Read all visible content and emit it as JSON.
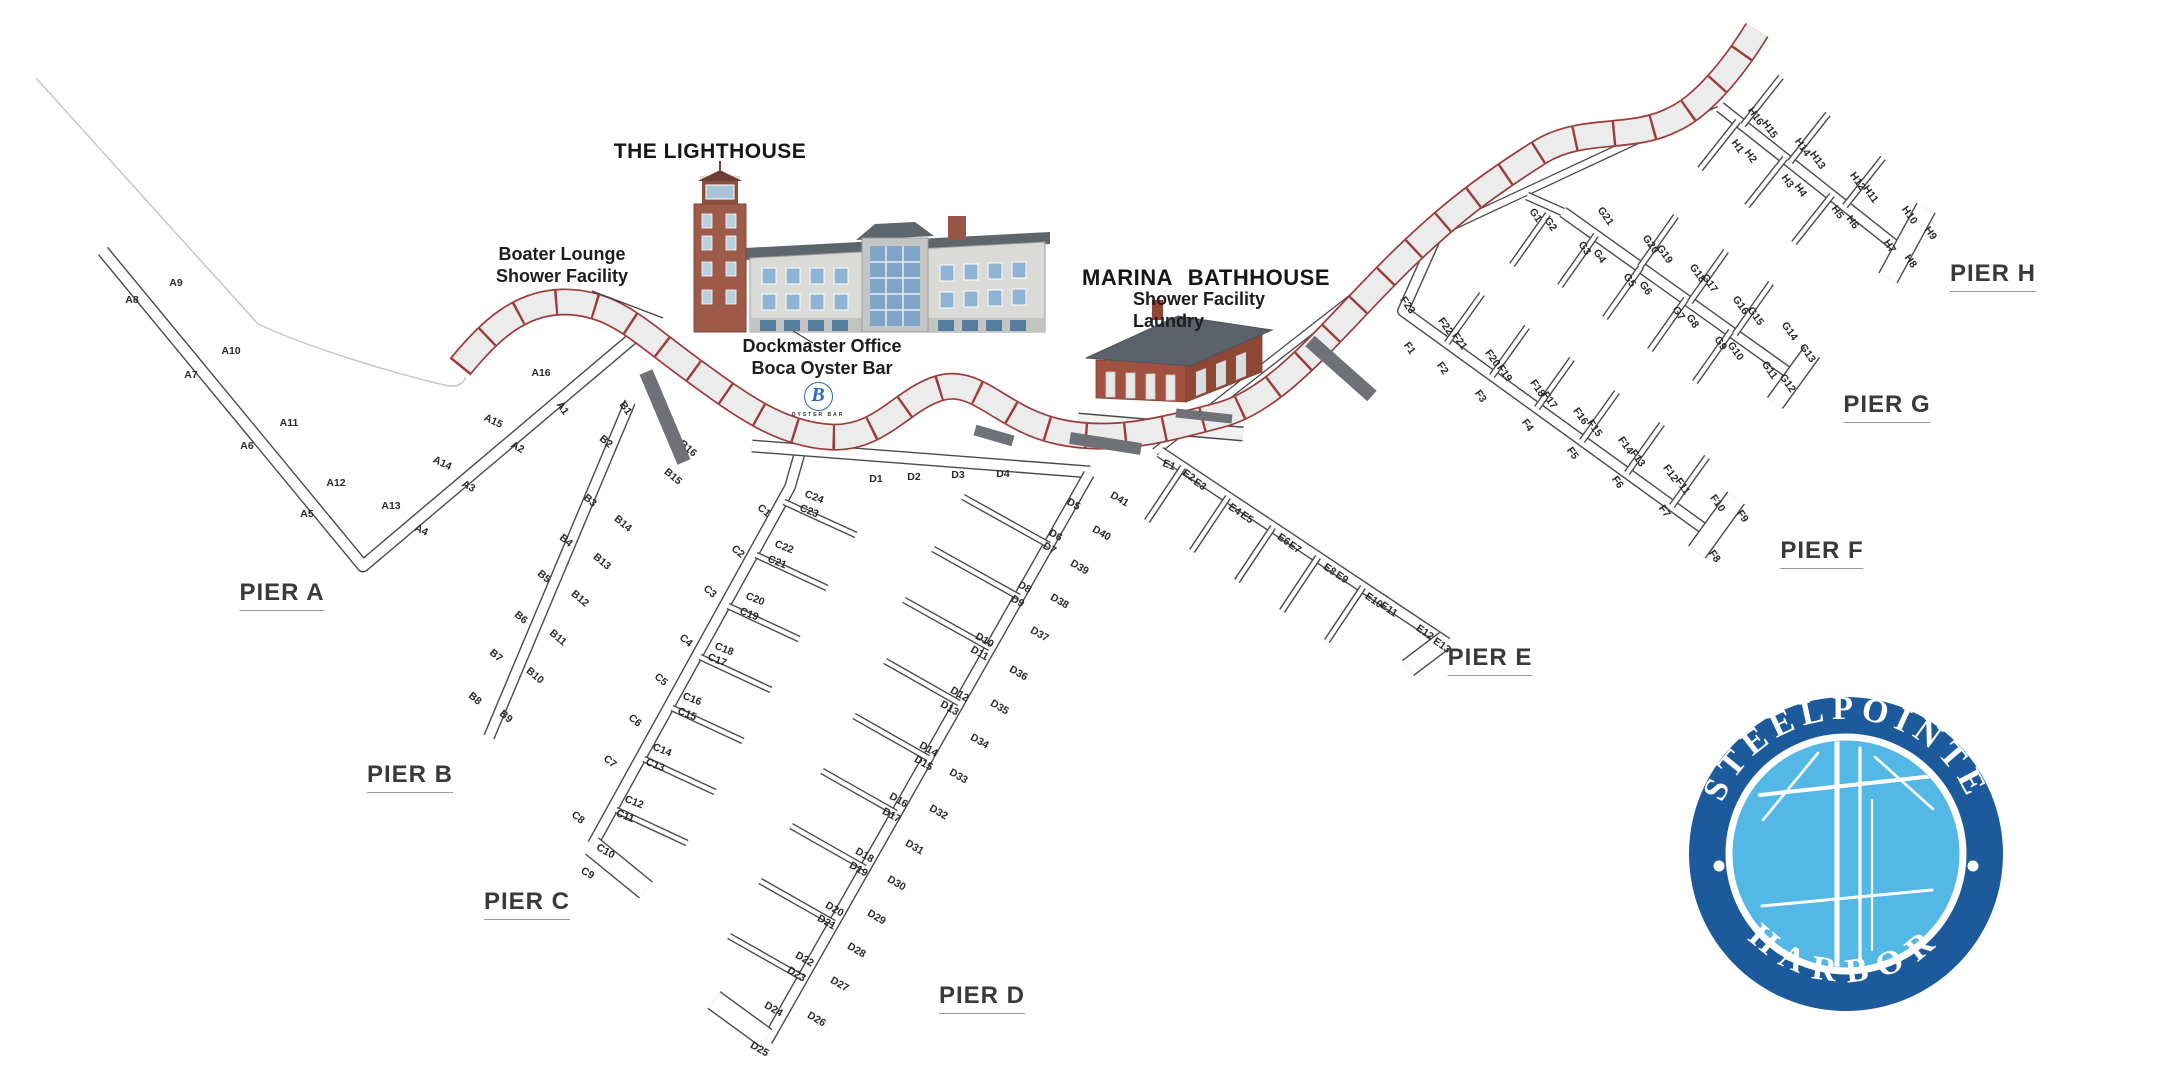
{
  "buildings": {
    "lighthouse": {
      "title": "THE LIGHTHOUSE",
      "callout_1": [
        "Boater Lounge",
        "Shower Facility"
      ],
      "callout_2": [
        "Dockmaster Office",
        "Boca Oyster Bar"
      ],
      "oyster_logo_letter": "B",
      "oyster_logo_caption": "OYSTER BAR"
    },
    "bathhouse": {
      "title": "MARINA  BATHHOUSE",
      "callout": [
        "Shower Facility",
        "Laundry"
      ]
    }
  },
  "piers": [
    {
      "id": "A",
      "label": "PIER A",
      "slips": [
        "A1",
        "A2",
        "A3",
        "A4",
        "A5",
        "A6",
        "A7",
        "A8",
        "A9",
        "A10",
        "A11",
        "A12",
        "A13",
        "A14",
        "A15",
        "A16"
      ]
    },
    {
      "id": "B",
      "label": "PIER B",
      "slips": [
        "B1",
        "B2",
        "B3",
        "B4",
        "B5",
        "B6",
        "B7",
        "B8",
        "B9",
        "B10",
        "B11",
        "B12",
        "B13",
        "B14",
        "B15",
        "B16"
      ]
    },
    {
      "id": "C",
      "label": "PIER C",
      "slips": [
        "C1",
        "C2",
        "C3",
        "C4",
        "C5",
        "C6",
        "C7",
        "C8",
        "C9",
        "C10",
        "C11",
        "C12",
        "C13",
        "C14",
        "C15",
        "C16",
        "C17",
        "C18",
        "C19",
        "C20",
        "C21",
        "C22",
        "C23",
        "C24"
      ]
    },
    {
      "id": "D",
      "label": "PIER D",
      "slips": [
        "D1",
        "D2",
        "D3",
        "D4",
        "D5",
        "D6",
        "D7",
        "D8",
        "D9",
        "D10",
        "D11",
        "D12",
        "D13",
        "D14",
        "D15",
        "D16",
        "D17",
        "D18",
        "D19",
        "D20",
        "D21",
        "D22",
        "D23",
        "D24",
        "D25",
        "D26",
        "D27",
        "D28",
        "D29",
        "D30",
        "D31",
        "D32",
        "D33",
        "D34",
        "D35",
        "D36",
        "D37",
        "D38",
        "D39",
        "D40",
        "D41"
      ]
    },
    {
      "id": "E",
      "label": "PIER E",
      "slips": [
        "E1",
        "E2",
        "E3",
        "E4",
        "E5",
        "E6",
        "E7",
        "E8",
        "E9",
        "E10",
        "E11",
        "E12",
        "E13"
      ]
    },
    {
      "id": "F",
      "label": "PIER F",
      "slips": [
        "F1",
        "F2",
        "F3",
        "F4",
        "F5",
        "F6",
        "F7",
        "F8",
        "F9",
        "F10",
        "F11",
        "F12",
        "F13",
        "F14",
        "F15",
        "F16",
        "F17",
        "F18",
        "F19",
        "F20",
        "F21",
        "F22",
        "F23"
      ]
    },
    {
      "id": "G",
      "label": "PIER G",
      "slips": [
        "G1",
        "G2",
        "G3",
        "G4",
        "G5",
        "G6",
        "G7",
        "G8",
        "G9",
        "G10",
        "G11",
        "G12",
        "G13",
        "G14",
        "G15",
        "G16",
        "G17",
        "G18",
        "G19",
        "G20",
        "G21"
      ]
    },
    {
      "id": "H",
      "label": "PIER H",
      "slips": [
        "H1",
        "H2",
        "H3",
        "H4",
        "H5",
        "H6",
        "H7",
        "H8",
        "H9",
        "H10",
        "H11",
        "H12",
        "H13",
        "H14",
        "H15",
        "H16"
      ]
    }
  ],
  "logo": {
    "top": "STEELPOINTE",
    "bottom": "HARBOR"
  },
  "colors": {
    "boardwalk_red": "#9c3b38",
    "boardwalk_fill": "#ececec",
    "dock_outline": "#4a4a4a",
    "gangway_gray": "#6e7277",
    "logo_ring_blue": "#1d5a9c",
    "logo_inner_blue": "#54b8e6"
  }
}
